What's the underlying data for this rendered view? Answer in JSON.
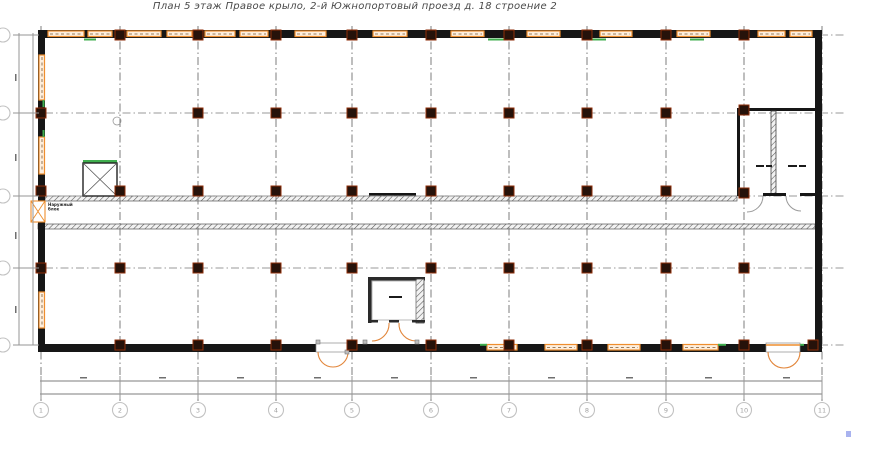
{
  "title": "План 5 этаж Правое крыло, 2-й Южнопортовый проезд д. 18 строение 2",
  "colors": {
    "wall": "#161616",
    "column_fill": "#26120a",
    "column_stroke": "#8f2e08",
    "window_stroke": "#ee8e2e",
    "window_fill": "#fdeedd",
    "mullion": "#7c5a33",
    "green": "#3fae4e",
    "arc_orange": "#e2863b",
    "arc_gray": "#999999",
    "grid_v": "#6f6f6f",
    "grid_h": "#9a9a9a",
    "hatch_stroke": "#555555",
    "band": "#969696",
    "bubble_stroke": "#c2c2c2",
    "bubble_text": "#a0a0a0",
    "tiny": "#1b1b1b",
    "blue_dot": "#a9b3ef"
  },
  "plan": {
    "outer_walls": [
      [
        38,
        30,
        784,
        8
      ],
      [
        38,
        344,
        784,
        8
      ],
      [
        38,
        30,
        7,
        322
      ],
      [
        815,
        30,
        7,
        322
      ]
    ],
    "grid": {
      "cols": [
        {
          "x": 41,
          "label": "1"
        },
        {
          "x": 120,
          "label": "2"
        },
        {
          "x": 198,
          "label": "3"
        },
        {
          "x": 276,
          "label": "4"
        },
        {
          "x": 352,
          "label": "5"
        },
        {
          "x": 431,
          "label": "6"
        },
        {
          "x": 509,
          "label": "7"
        },
        {
          "x": 587,
          "label": "8"
        },
        {
          "x": 666,
          "label": "9"
        },
        {
          "x": 744,
          "label": "10"
        },
        {
          "x": 822,
          "label": "11"
        }
      ],
      "rows": [
        {
          "y": 35,
          "label": ""
        },
        {
          "y": 113,
          "label": ""
        },
        {
          "y": 196,
          "label": ""
        },
        {
          "y": 268,
          "label": ""
        },
        {
          "y": 345,
          "label": ""
        }
      ],
      "v_y1": 26,
      "v_y2": 401,
      "h_x1": 14,
      "h_x2": 846,
      "bubble_cy": 410,
      "bubble_r": 7.5,
      "left_bubble_cx": 3,
      "left_bubble_r": 7
    },
    "windows_top": [
      [
        48,
        84
      ],
      [
        88,
        112
      ],
      [
        127,
        161
      ],
      [
        167,
        192
      ],
      [
        205,
        235
      ],
      [
        240,
        268
      ],
      [
        295,
        326
      ],
      [
        373,
        407
      ],
      [
        451,
        484
      ],
      [
        527,
        560
      ],
      [
        600,
        632
      ],
      [
        677,
        710
      ],
      [
        758,
        785
      ],
      [
        790,
        812
      ]
    ],
    "windows_left": [
      [
        55,
        100
      ],
      [
        137,
        174
      ],
      [
        292,
        328
      ]
    ],
    "windows_bottom": [
      [
        487,
        517
      ],
      [
        545,
        577
      ],
      [
        608,
        640
      ],
      [
        683,
        718
      ]
    ],
    "green_ticks_top": [
      [
        84,
        96
      ],
      [
        488,
        508
      ],
      [
        592,
        606
      ],
      [
        690,
        704
      ]
    ],
    "green_ticks_left": [
      [
        100,
        107
      ],
      [
        130,
        137
      ]
    ],
    "green_ticks_bottom": [
      [
        480,
        487
      ],
      [
        718,
        726
      ],
      [
        797,
        804
      ]
    ],
    "columns": [
      [
        120,
        35
      ],
      [
        198,
        35
      ],
      [
        276,
        35
      ],
      [
        352,
        35
      ],
      [
        431,
        35
      ],
      [
        509,
        35
      ],
      [
        587,
        35
      ],
      [
        666,
        35
      ],
      [
        744,
        35
      ],
      [
        41,
        113
      ],
      [
        198,
        113
      ],
      [
        276,
        113
      ],
      [
        352,
        113
      ],
      [
        431,
        113
      ],
      [
        509,
        113
      ],
      [
        587,
        113
      ],
      [
        666,
        113
      ],
      [
        744,
        110
      ],
      [
        41,
        191
      ],
      [
        120,
        191
      ],
      [
        198,
        191
      ],
      [
        276,
        191
      ],
      [
        352,
        191
      ],
      [
        431,
        191
      ],
      [
        509,
        191
      ],
      [
        587,
        191
      ],
      [
        666,
        191
      ],
      [
        744,
        193
      ],
      [
        41,
        268
      ],
      [
        120,
        268
      ],
      [
        198,
        268
      ],
      [
        276,
        268
      ],
      [
        352,
        268
      ],
      [
        431,
        268
      ],
      [
        509,
        268
      ],
      [
        587,
        268
      ],
      [
        666,
        268
      ],
      [
        744,
        268
      ],
      [
        120,
        345
      ],
      [
        198,
        345
      ],
      [
        276,
        345
      ],
      [
        352,
        345
      ],
      [
        431,
        345
      ],
      [
        509,
        345
      ],
      [
        587,
        345
      ],
      [
        666,
        345
      ],
      [
        744,
        345
      ],
      [
        813,
        345
      ]
    ],
    "corridor": {
      "hatch_a": [
        45,
        196,
        692,
        5
      ],
      "hatch_b": [
        38,
        224,
        777,
        5
      ],
      "beam": [
        369,
        193,
        47,
        2.5
      ]
    },
    "stair": {
      "box": [
        83,
        163,
        34,
        33
      ],
      "green_top": [
        83,
        160,
        34,
        3
      ]
    },
    "circle_mark": {
      "cx": 117,
      "cy": 121,
      "r": 4
    },
    "outdoor_unit": {
      "box": [
        31,
        201,
        14,
        21
      ],
      "label_lines": [
        "Наружный",
        "блок"
      ],
      "label_x": 48,
      "label_y": 206
    },
    "rooms": {
      "fill": [
        737,
        108,
        78,
        88
      ],
      "top_wall": [
        737,
        108,
        78,
        3
      ],
      "left_wall": [
        737,
        108,
        3,
        88
      ],
      "divider": [
        771,
        111,
        5,
        83
      ],
      "bottom_segments": [
        [
          737,
          193,
          10,
          3
        ],
        [
          763,
          193,
          23,
          3
        ],
        [
          800,
          193,
          15,
          3
        ]
      ],
      "door_arcs": [
        "M 763 196 A 16 16 0 0 1 747 212",
        "M 786 196 A 15 15 0 0 0 801 211"
      ],
      "label_bars": [
        [
          756,
          165,
          8
        ],
        [
          766,
          165,
          6
        ],
        [
          788,
          165,
          9
        ],
        [
          799,
          165,
          7
        ]
      ]
    },
    "shaft": {
      "fill": [
        368,
        277,
        57,
        46
      ],
      "top": [
        368,
        277,
        57,
        3.5
      ],
      "left": [
        368,
        277,
        3.5,
        46
      ],
      "right_hatch": [
        416,
        279,
        8,
        44
      ],
      "inner": [
        372,
        281,
        44,
        39
      ],
      "bottom_segments": [
        [
          368,
          320,
          10,
          2.5
        ],
        [
          389,
          320,
          10,
          2.5
        ],
        [
          412,
          320,
          13,
          2.5
        ]
      ],
      "arcs": [
        "M 389 323 A 17 17 0 0 1 372 341",
        "M 399 323 A 17 17 0 0 0 416 341"
      ],
      "label_bar": [
        389,
        296,
        13
      ]
    },
    "doors_bottom": [
      {
        "opening": [
          316,
          343,
          32,
          9
        ],
        "orange_top": false,
        "arcs": [
          "M 318 352 A 15 15 0 0 0 333 367",
          "M 348 352 A 15 15 0 0 1 333 367"
        ]
      },
      {
        "opening": [
          766,
          343,
          34,
          9
        ],
        "orange_top": true,
        "arcs": [
          "M 768 352 A 16 16 0 0 0 784 368",
          "M 800 352 A 16 16 0 0 1 784 368"
        ]
      }
    ],
    "gray_posts": [
      [
        363,
        340
      ],
      [
        415,
        340
      ],
      [
        316,
        340
      ],
      [
        345,
        350
      ]
    ],
    "band_bottom": {
      "lines": [
        [
          40,
          381,
          822,
          381
        ],
        [
          40,
          394,
          822,
          394
        ]
      ],
      "tick_y1": 376,
      "tick_y2": 399,
      "dim_marks_y": 377,
      "dim_mark_xs": [
        80,
        159,
        237,
        314,
        391,
        470,
        548,
        626,
        705,
        783
      ]
    },
    "band_left": {
      "lines": [
        [
          19,
          33,
          19,
          345
        ],
        [
          33,
          33,
          33,
          345
        ]
      ],
      "tick_x1": 13,
      "tick_x2": 39,
      "dim_marks_x": 15,
      "dim_mark_ys": [
        74,
        154,
        232,
        306
      ]
    },
    "blue_dot": [
      846,
      431,
      5,
      6
    ]
  }
}
